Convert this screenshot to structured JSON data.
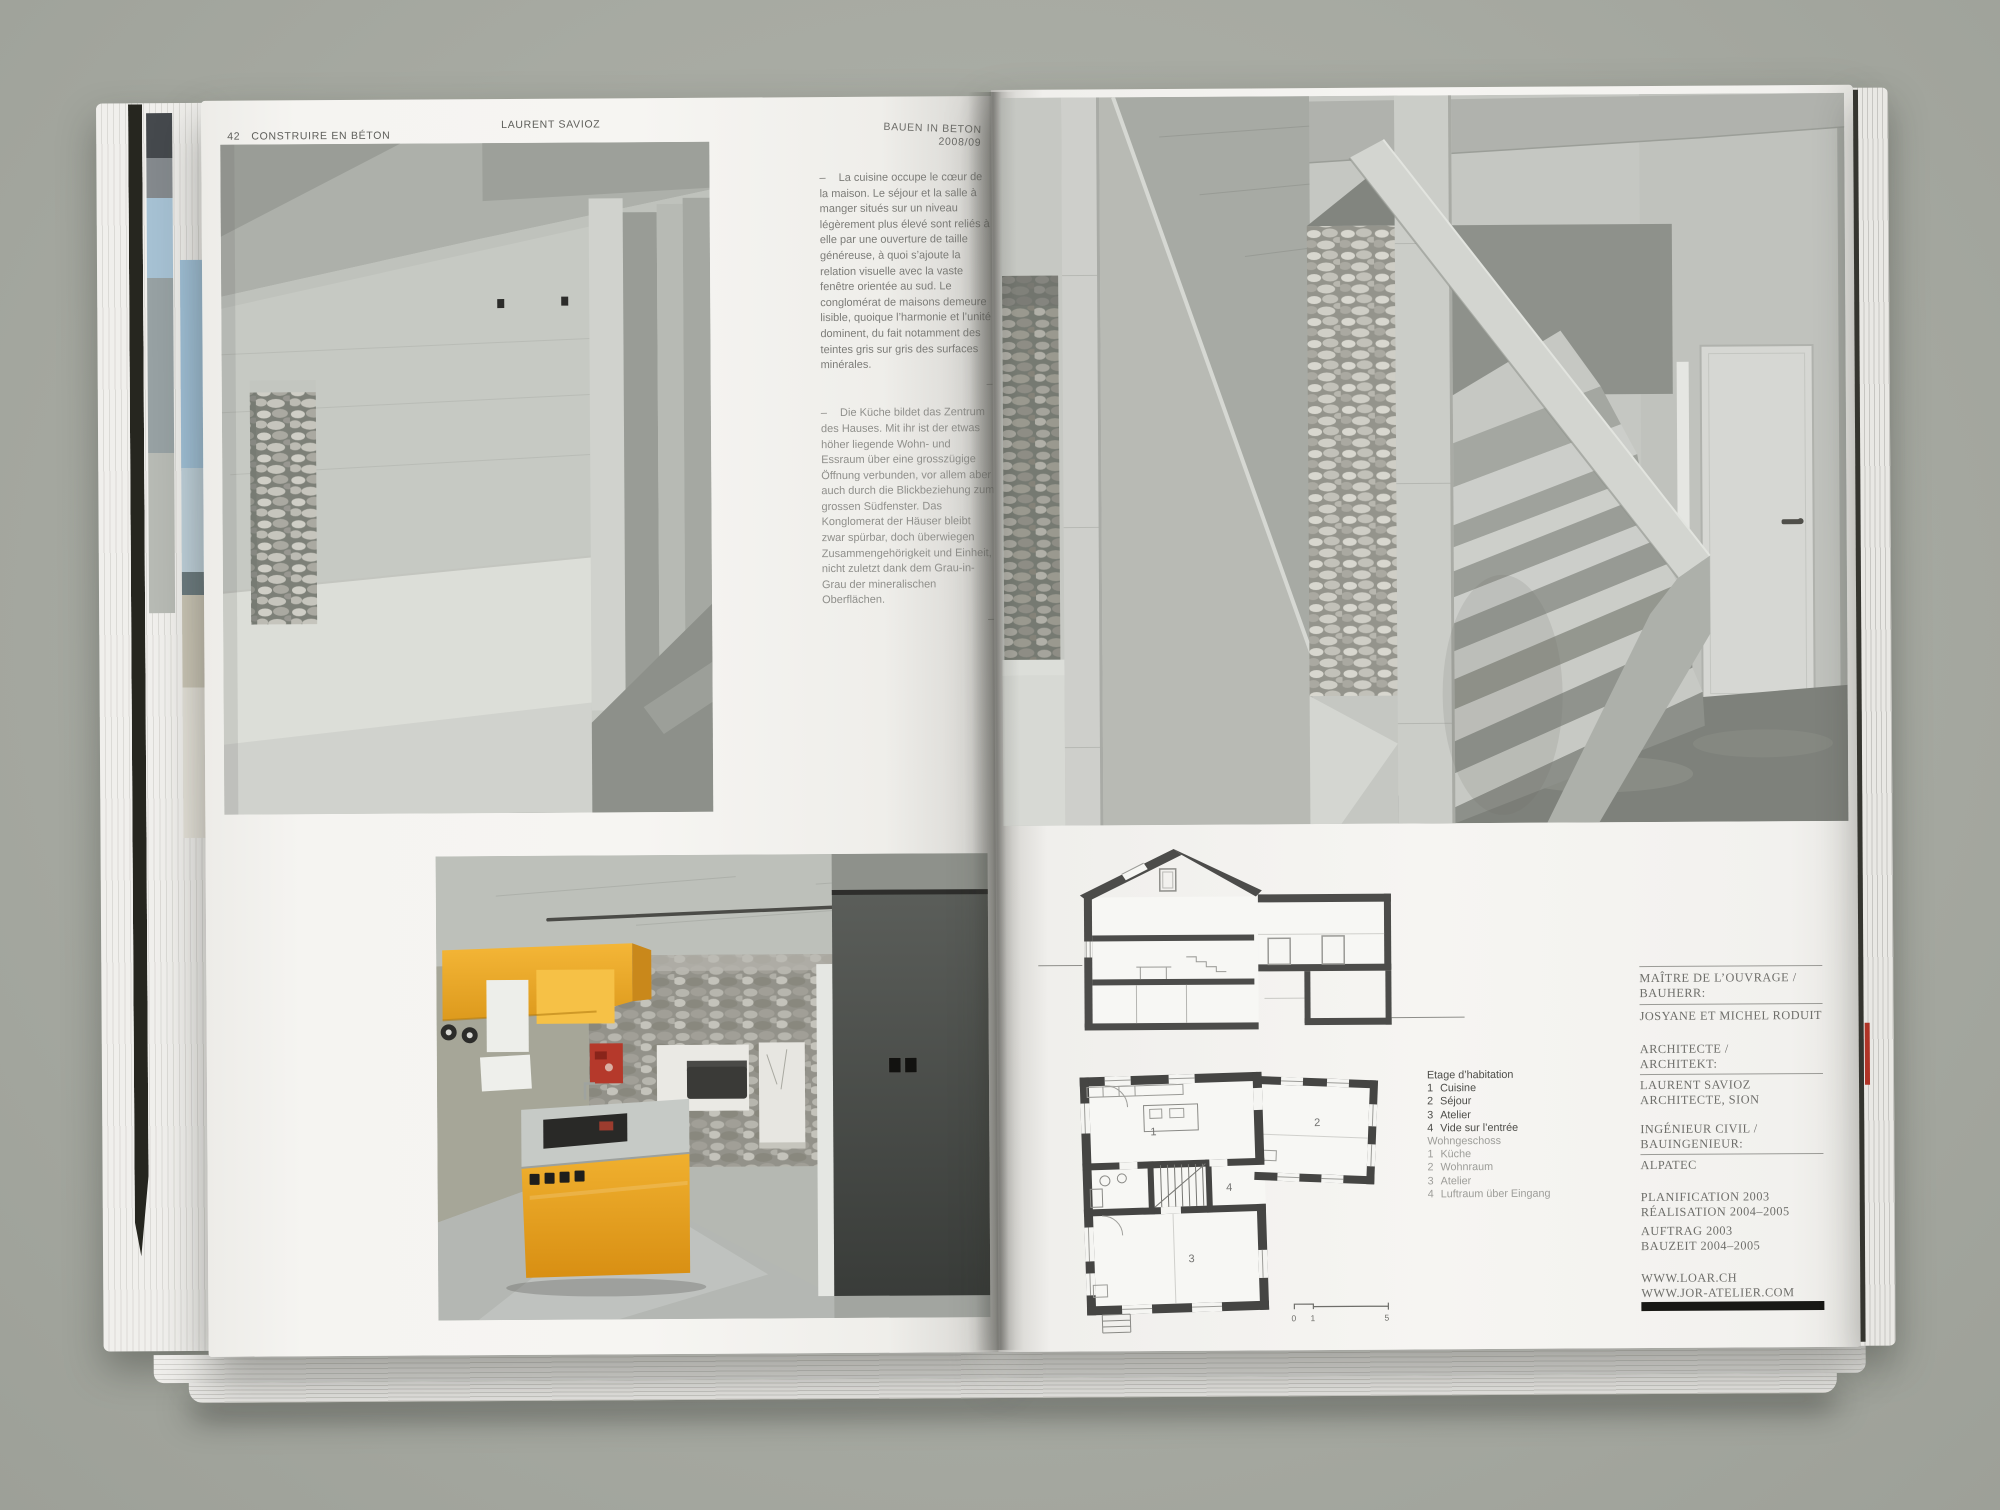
{
  "book": {
    "left_header": {
      "page_number": "42",
      "title": "CONSTRUIRE EN BÉTON",
      "year": "2008/09",
      "author": "LAURENT SAVIOZ"
    },
    "right_header": {
      "title": "BAUEN IN BETON",
      "year": "2008/09"
    },
    "intro_fr": {
      "marker": "–",
      "text": "La cuisine occupe le cœur de la maison. Le séjour et la salle à manger situés sur un niveau légèrement plus élevé sont reliés à elle par une ouverture de taille généreuse, à quoi s’ajoute la relation visuelle avec la vaste fenêtre orientée au sud. Le conglomérat de maisons demeure lisible, quoique l’harmonie et l’unité dominent, du fait notamment des teintes gris sur gris des surfaces minérales.",
      "end_mark": "–"
    },
    "intro_de": {
      "marker": "–",
      "text": "Die Küche bildet das Zentrum des Hauses. Mit ihr ist der etwas höher liegende Wohn- und Essraum über eine grosszügige Öffnung verbunden, vor allem aber auch durch die Blickbeziehung zum grossen Südfenster. Das Konglomerat der Häuser bleibt zwar spürbar, doch überwiegen Zusammengehörigkeit und Einheit, nicht zuletzt dank dem Grau-in-Grau der mineralischen Oberflächen.",
      "end_mark": "–"
    },
    "legend": {
      "fr": {
        "title": "Etage d’habitation",
        "items": [
          {
            "n": "1",
            "t": "Cuisine"
          },
          {
            "n": "2",
            "t": "Séjour"
          },
          {
            "n": "3",
            "t": "Atelier"
          },
          {
            "n": "4",
            "t": "Vide sur l’entrée"
          }
        ]
      },
      "de": {
        "title": "Wohngeschoss",
        "items": [
          {
            "n": "1",
            "t": "Küche"
          },
          {
            "n": "2",
            "t": "Wohnraum"
          },
          {
            "n": "3",
            "t": "Atelier"
          },
          {
            "n": "4",
            "t": "Luftraum über Eingang"
          }
        ]
      }
    },
    "plan": {
      "rooms": {
        "r1": "1",
        "r2": "2",
        "r3": "3",
        "r4": "4"
      },
      "scale": {
        "s0": "0",
        "s1": "1",
        "s5": "5"
      }
    },
    "credits": {
      "blocks": [
        {
          "l1": "MAÎTRE DE L’OUVRAGE /",
          "l2": "BAUHERR:",
          "v1": "JOSYANE ET MICHEL RODUIT",
          "v2": ""
        },
        {
          "l1": "ARCHITECTE /",
          "l2": "ARCHITEKT:",
          "v1": "LAURENT SAVIOZ",
          "v2": "ARCHITECTE, SION"
        },
        {
          "l1": "INGÉNIEUR CIVIL /",
          "l2": "BAUINGENIEUR:",
          "v1": "ALPATEC",
          "v2": ""
        }
      ],
      "schedule_fr": [
        "PLANIFICATION 2003",
        "RÉALISATION 2004–2005"
      ],
      "schedule_de": [
        "AUFTRAG 2003",
        "BAUZEIT 2004–2005"
      ],
      "websites": [
        "WWW.LOAR.CH",
        "WWW.JOR-ATELIER.COM"
      ]
    },
    "colors": {
      "background": "#a9aca4",
      "paper": "#f4f3f0",
      "accent_yellow": "#edaa2e",
      "accent_red": "#b5392b",
      "ink": "#565652"
    }
  }
}
